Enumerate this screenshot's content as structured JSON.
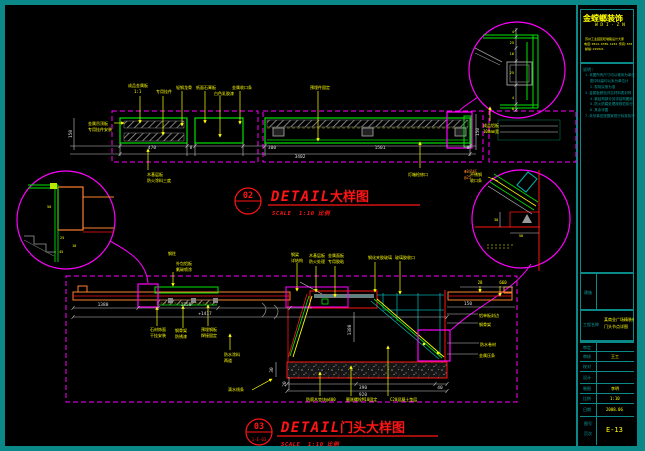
{
  "colors": {
    "frame": "#0b8888",
    "magenta": "#ff00ff",
    "green": "#00e400",
    "yellow": "#ffff00",
    "red": "#ff1515",
    "orange": "#ff7f2a",
    "gray": "#999999",
    "dim_line": "#c8c8c8"
  },
  "t1": {
    "no": "02",
    "sub": "—",
    "en": "DETAIL",
    "cn": "大样图",
    "scale_en": "SCALE",
    "scale_val": "1:10",
    "scale_cn": "比例"
  },
  "t2": {
    "no": "03",
    "sub": "1-E-03",
    "en": "DETAIL",
    "cn": "门头大样图",
    "scale_en": "SCALE",
    "scale_val": "1:10",
    "scale_cn": "比例"
  },
  "d1": {
    "top_labels": [
      "成品金属板",
      "专用挂件",
      "轻钢龙骨",
      "纸面石膏板",
      "白色乳胶漆",
      "金属收口条",
      "预埋件固定"
    ],
    "top_label_sub": "1:1",
    "left_label1": "金属吊顶板",
    "left_label2": "专用挂件安装",
    "bottom_label1": "木基层板",
    "bottom_label2": "防火涂料三度",
    "mid_label": "灯箱检修口",
    "right_label1": "Φ8吊杆",
    "right_label2": "@25",
    "dim_470": "470",
    "dim_8a": "8",
    "dim_300": "300",
    "dim_1501": "1501",
    "dim_8b": "8",
    "dim_total": "3402",
    "dim_150L": "150",
    "dim_150R": "150"
  },
  "c1": {
    "dims": [
      "4",
      "25",
      "16",
      "25",
      "4",
      "8"
    ],
    "label1": "成品铝板",
    "label2": "100mm宽"
  },
  "c2": {
    "dims": [
      "50",
      "25",
      "10",
      "45"
    ]
  },
  "c3": {
    "dim_30": "30",
    "dim_50": "50",
    "label1": "不锈钢",
    "label2": "收口条"
  },
  "d2": {
    "lab_a1": "钢柱",
    "lab_a2a": "外包铝板",
    "lab_a2b": "氟碳喷涂",
    "lab_b1": "钢梁",
    "lab_b2": "详结构",
    "lab_c1": "木基层板",
    "lab_c2": "防火处理",
    "lab_d1": "金属面板",
    "lab_d2": "专用胶粘",
    "lab_e": "钢化夹胶玻璃",
    "lab_f": "玻璃胶收口",
    "lab_r1": "铝单板封边",
    "lab_r2": "钢骨架",
    "lab_r3": "防水卷材",
    "lab_r4": "金属压条",
    "lab_l1a": "石材饰面",
    "lab_l1b": "干挂安装",
    "lab_l2a": "钢骨架",
    "lab_l2b": "防锈漆",
    "lab_l3a": "预埋钢板",
    "lab_l3b": "焊接固定",
    "lab_l4a": "防水涂料",
    "lab_l4b": "两道",
    "lab_l5": "滴水线条",
    "lab_bt1": "防腐木垫块@400",
    "lab_bt2": "膨胀螺栓M10固定",
    "lab_bt3": "C20混凝土垫层",
    "dim_1380": "1380",
    "dim_1350": "1350",
    "dim_1417": "+1417",
    "dim_150": "150",
    "dim_390": "390",
    "dim_40": "40",
    "dim_920": "920",
    "dim_30": "30",
    "dim_20": "20",
    "dim_28": "28",
    "dim_660": "660",
    "dim_v1380": "1380"
  },
  "tb": {
    "logo_line1": "金螳螂装饰",
    "logo_line2": "W D I · Z N",
    "addr": [
      "苏州工业园区旺墩路设计大厦",
      "电话:0512-6789-1234 传真:6789-1235",
      "邮编:215021"
    ],
    "notes_title": "说明:",
    "notes": [
      "1.本图所有尺寸均以毫米为单位",
      "图中标高均以米为单位计",
      "2.现场实测为准",
      "3.金属板颜色详见材料表封样",
      "4.钢结构部分另详结构图纸",
      "5.防火防腐处理按规范执行",
      "6.其余详图",
      "7.未尽事宜按国家现行标准执行"
    ],
    "major_label": "建施",
    "project_label": "工程名称",
    "project_value1": "某商业广场精装修工程",
    "project_value2": "门头节点详图",
    "rows": [
      {
        "label": "审定",
        "value": ""
      },
      {
        "label": "审核",
        "value": "王工"
      },
      {
        "label": "校对",
        "value": ""
      },
      {
        "label": "设计",
        "value": ""
      },
      {
        "label": "制图",
        "value": "李明"
      },
      {
        "label": "比例",
        "value": "1:10"
      },
      {
        "label": "日期",
        "value": "2008.06"
      }
    ],
    "drawing_no_label": "图号",
    "drawing_no_sub": "页次",
    "drawing_no_value": "E-13"
  }
}
